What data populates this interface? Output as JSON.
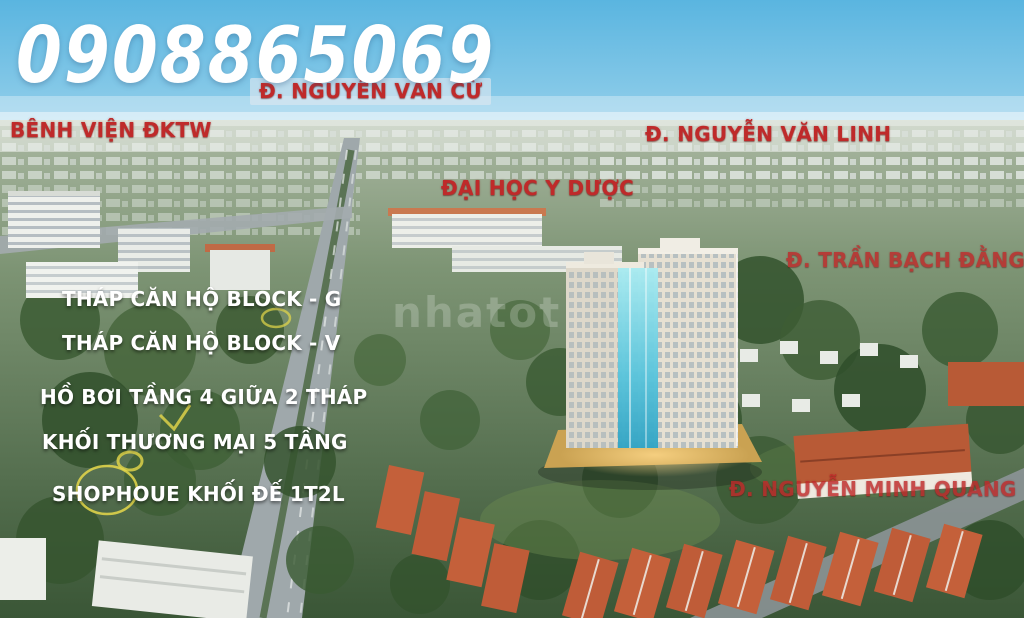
{
  "poster": {
    "phone_overlay": "0908865069",
    "watermark": "nhatot"
  },
  "logo": {
    "brand": "THIENQUAN MARINA",
    "brand_sub": "PLAZA",
    "phone": "0932 777 839",
    "phone_icon": "☎"
  },
  "location_labels": [
    {
      "text": "Đ. NGUYỄN VĂN CỪ"
    },
    {
      "text": "BÊNH VIỆN ĐKTW"
    },
    {
      "text": "Đ. NGUYỄN VĂN LINH"
    },
    {
      "text": "ĐẠI HỌC Y DƯỢC"
    },
    {
      "text": "Đ. TRẦN BẠCH ĐẰNG"
    },
    {
      "text": "Đ. NGUYỄN  MINH QUANG"
    }
  ],
  "feature_labels": [
    {
      "text": "THÁP CĂN HỘ BLOCK - G"
    },
    {
      "text": "THÁP CĂN HỘ BLOCK - V"
    },
    {
      "text": "HỒ BƠI TẦNG 4 GIỮA 2 THÁP"
    },
    {
      "text": "KHỐI THƯƠNG MẠI 5 TẦNG"
    },
    {
      "text": "SHOPHOUE  KHỐI ĐẾ 1T2L"
    }
  ],
  "colors": {
    "label_red": "#bf2a2a",
    "pin_gold": "#edbf27",
    "leader_line": "#d89a95",
    "text_white": "#ffffff",
    "sky_blue": "#62b9e2"
  }
}
